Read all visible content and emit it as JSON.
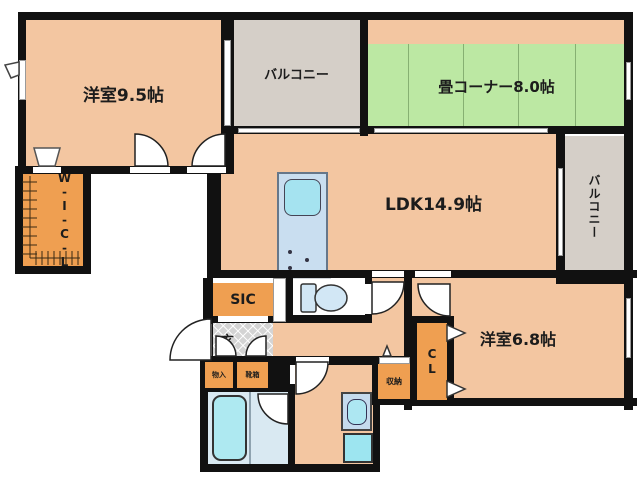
{
  "rooms": {
    "bedroom_main": {
      "label": "洋室9.5帖"
    },
    "balcony_top": {
      "label": "バルコニー"
    },
    "tatami_corner": {
      "label": "畳コーナー8.0帖"
    },
    "ldk": {
      "label": "LDK14.9帖"
    },
    "balcony_right": {
      "label": "バルコニー"
    },
    "walk_in_closet": {
      "label": "W-I-C-L"
    },
    "shoes_in_closet": {
      "label": "SIC"
    },
    "entrance": {
      "label": "玄"
    },
    "cabinet_small_1": {
      "label": "物入"
    },
    "cabinet_small_2": {
      "label": "靴箱"
    },
    "storage": {
      "label": "収納"
    },
    "closet": {
      "label": "CL"
    },
    "bedroom_second": {
      "label": "洋室6.8帖"
    }
  },
  "fixtures": {
    "bathtub": "bathtub-top-view",
    "toilet": "toilet-top-view",
    "wash_basin": "vanity-basin",
    "washing_machine": "washer-pan",
    "kitchen_sink": "counter-sink",
    "stove": "burner-dots",
    "door_arcs": "quarter-circle-swing-doors",
    "closet_hatch": "hanger-pipe-ticks"
  },
  "colors": {
    "wall": "#111111",
    "room_floor": "#f3c6a1",
    "storage_fill": "#ef9f51",
    "tatami_green": "#bce8a3",
    "balcony_gray": "#d5cfc8",
    "wet_area_blue": "#d9e9f2",
    "fixture_cyan": "#aee9f1",
    "kitchen_blue": "#c9def0",
    "entrance_tile": "#d4d4d4"
  }
}
